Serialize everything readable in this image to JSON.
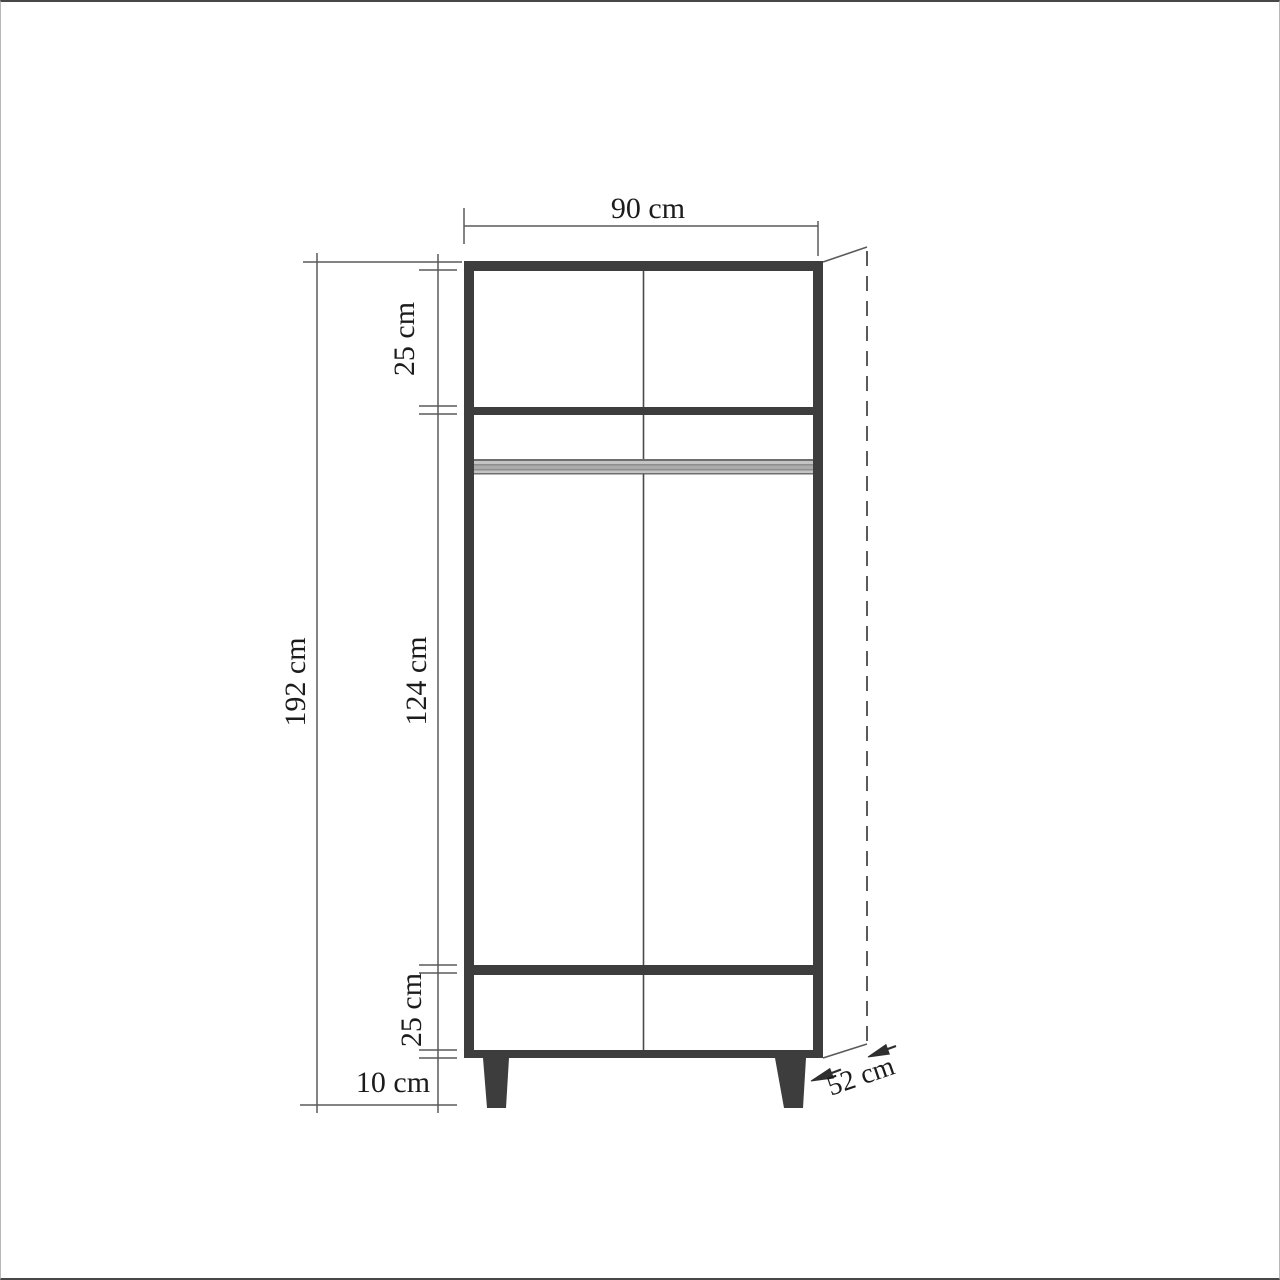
{
  "page": {
    "background": "#ffffff",
    "border_color": "#474747"
  },
  "drawing": {
    "title": "wardrobe front elevation dimension drawing",
    "labels": {
      "width": "90 cm",
      "height": "192 cm",
      "top_section": "25 cm",
      "middle_section": "124 cm",
      "drawer_section": "25 cm",
      "legs": "10 cm",
      "depth": "52 cm"
    },
    "colors": {
      "furniture": "#3d3d3d",
      "dimension_lines": "#5a5a5a",
      "text": "#1c1c1c",
      "rail_gray": "#a8a8a8"
    }
  }
}
